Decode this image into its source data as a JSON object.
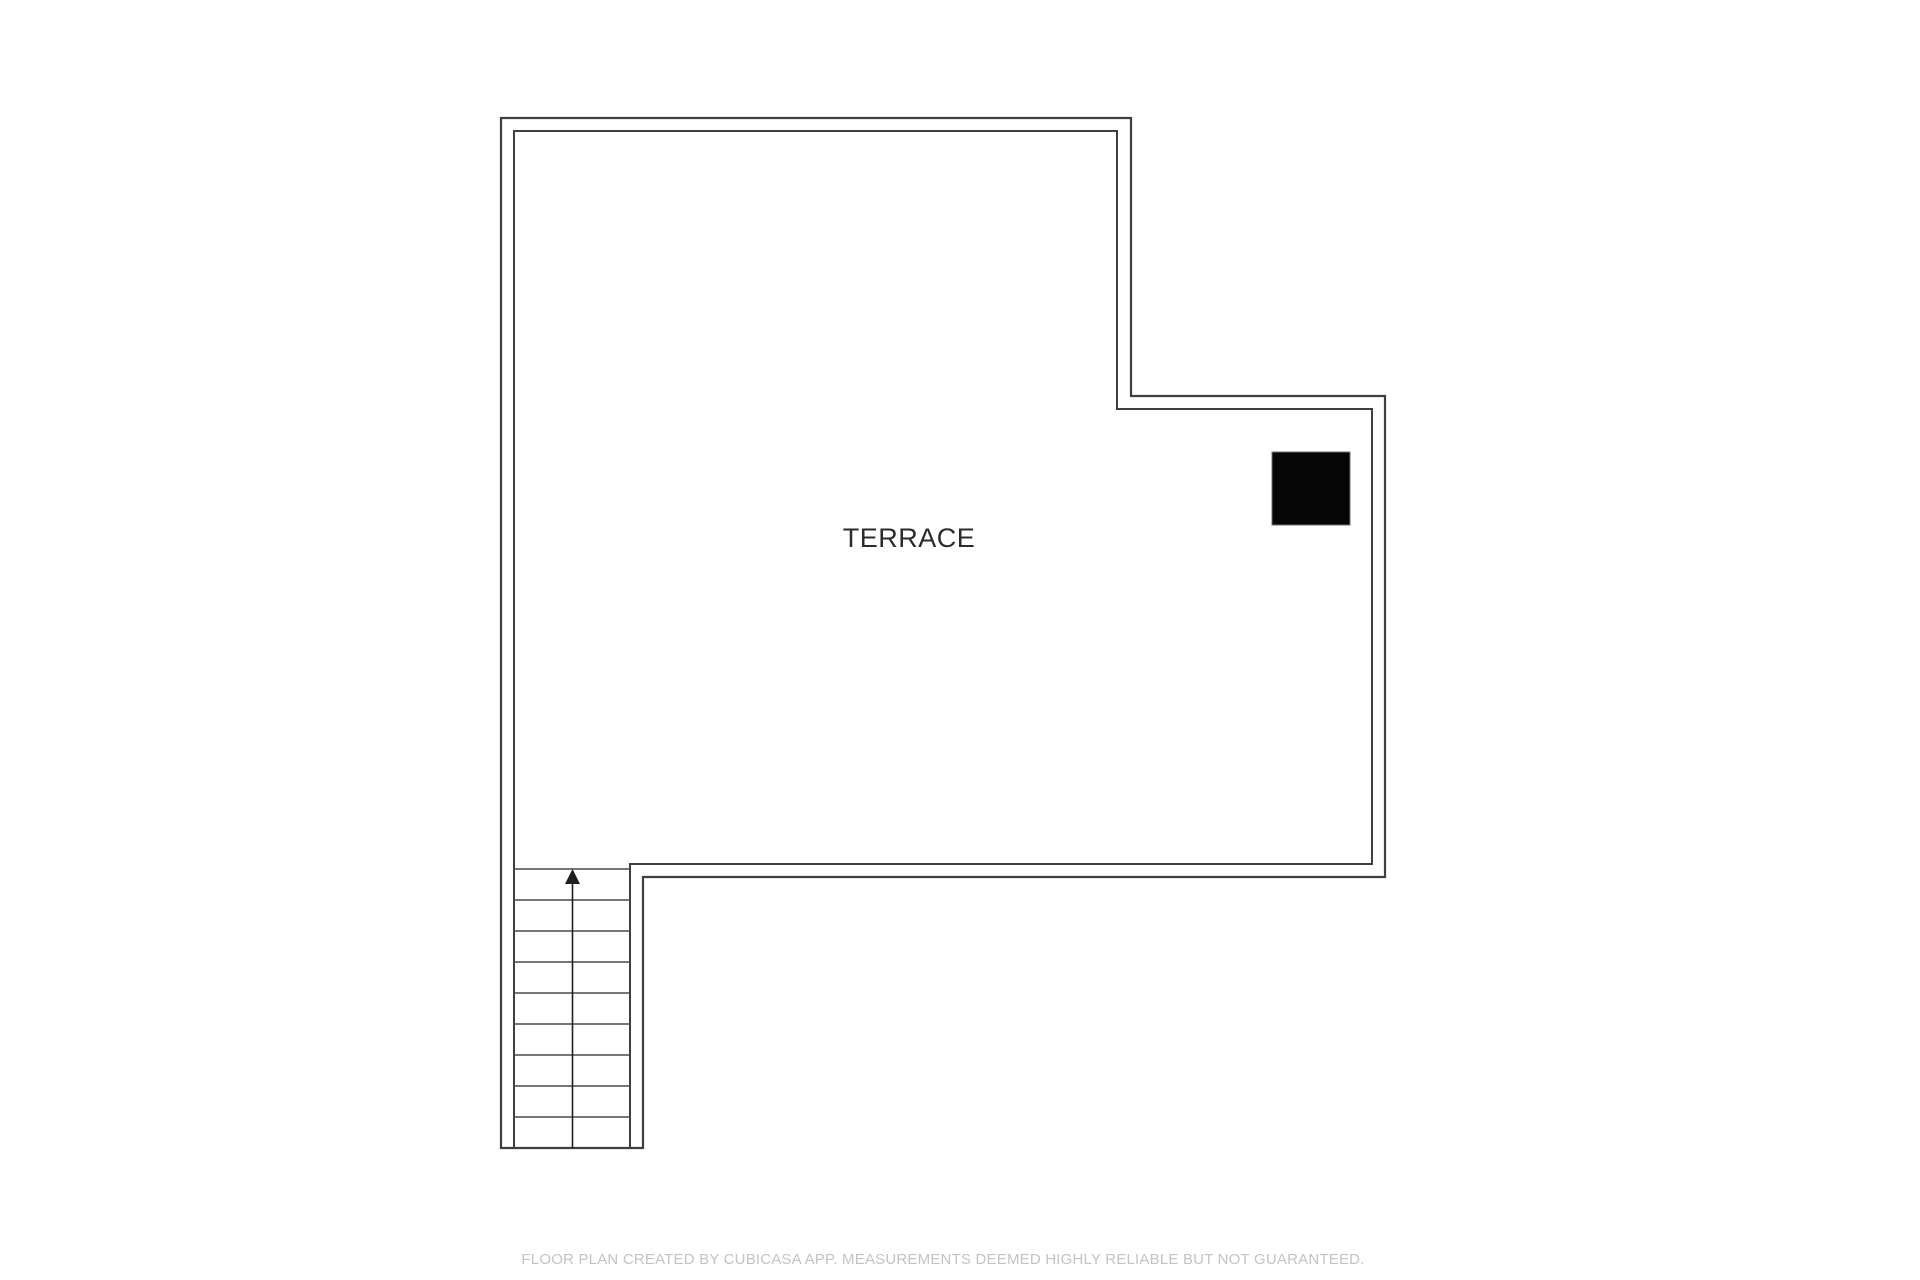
{
  "page": {
    "background": "#ffffff",
    "width": 1920,
    "height": 1280
  },
  "floor_plan": {
    "room_label": "TERRACE",
    "footer_text": "FLOOR PLAN CREATED BY CUBICASA APP. MEASUREMENTS DEEMED HIGHLY RELIABLE BUT NOT GUARANTEED.",
    "colors": {
      "wall_line": "#3f3f3f",
      "tread_line": "#4a4a4a",
      "arrow": "#1f1f1f",
      "label_text": "#2b2b2b",
      "footer_text": "#c3c3c3",
      "fixture_fill": "#060606",
      "fixture_edge": "#6f6f6f",
      "background": "#ffffff"
    },
    "geometry": {
      "outer_outline_points": "501,118 1131,118 1131,396 1385,396 1385,877 643,877 643,1148 501,1148",
      "inner_outline_path": "M514,1148 L514,131 L1117,131 L1117,409 L1372,409 L1372,864 L630,864 L630,1148",
      "stairs": {
        "x1": 514,
        "x2": 630,
        "y_start": 869,
        "step": 31,
        "tread_count": 9,
        "y_bottom": 1148,
        "arrow_x": 572.5,
        "arrow_tip_y": 869,
        "arrow_base_y": 884,
        "arrow_half_width": 7.5
      },
      "fixture": {
        "x": 1272,
        "y": 452,
        "width": 78,
        "height": 73
      },
      "label_pos": {
        "x": 909,
        "y": 547
      }
    }
  }
}
